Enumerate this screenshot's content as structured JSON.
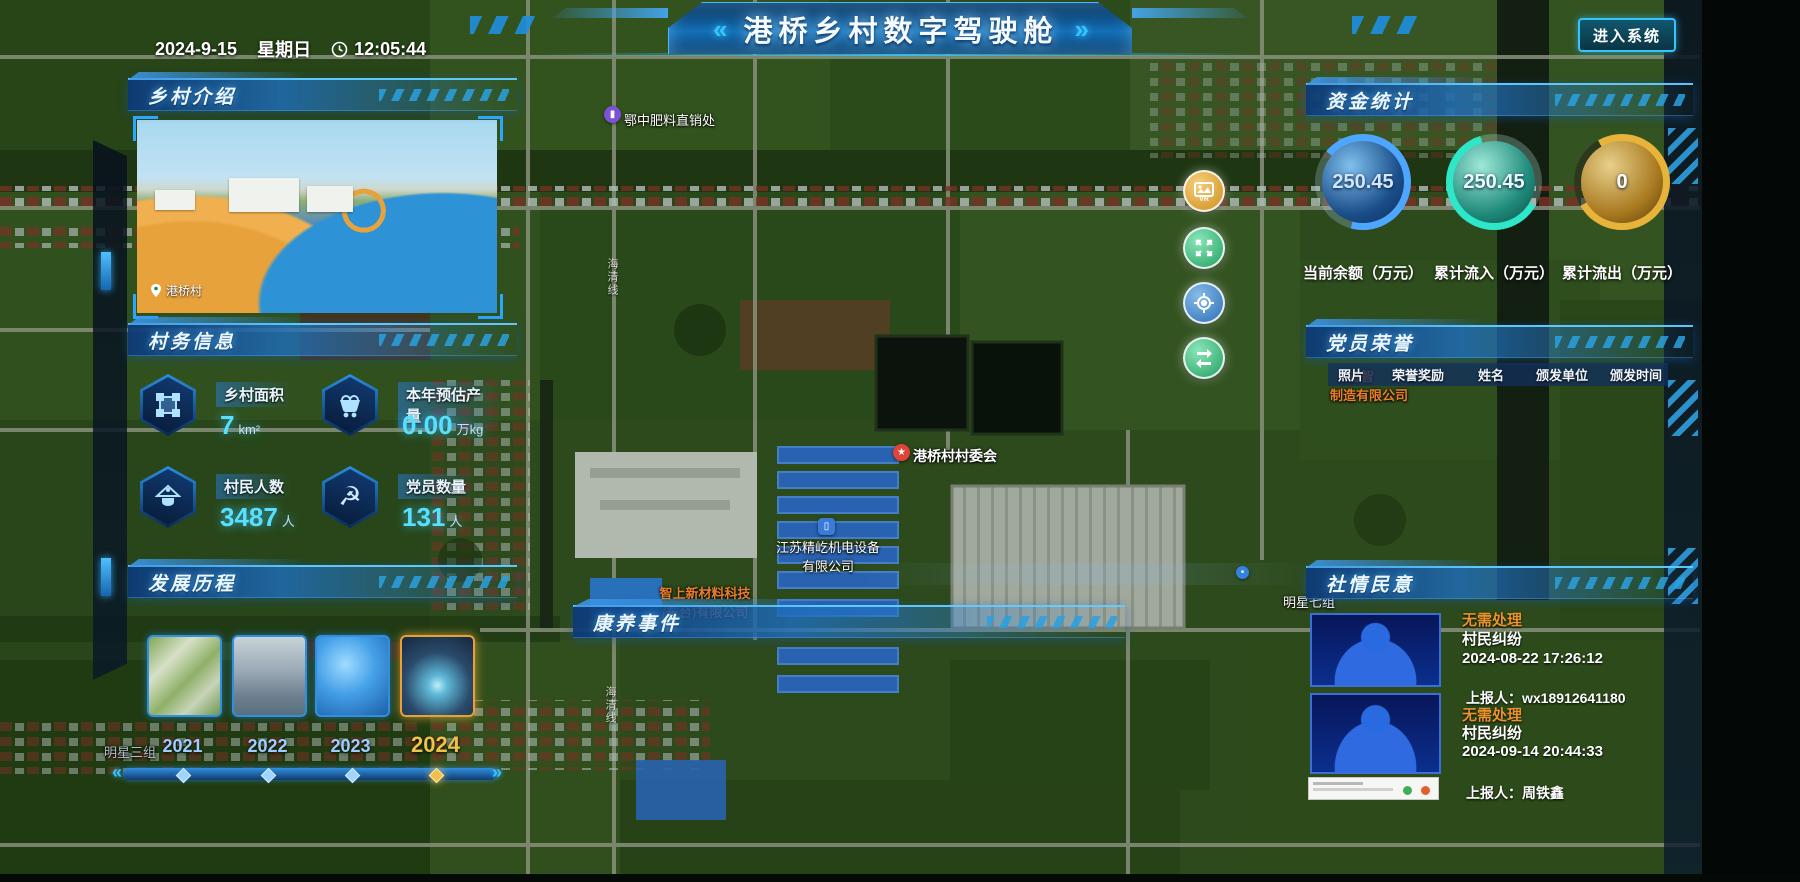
{
  "header": {
    "title": "港桥乡村数字驾驶舱",
    "chevron_left": "«",
    "chevron_right": "»",
    "date": "2024-9-15",
    "weekday": "星期日",
    "time": "12:05:44",
    "enter_button": "进入系统"
  },
  "colors": {
    "accent_cyan": "#35c4ff",
    "value_cyan": "#59e0ff",
    "status_orange": "#e8932a",
    "year_gold": "#f0c04a",
    "gauge_blue": "#4da6ff",
    "gauge_teal": "#2ee6c8",
    "gauge_gold": "#e8b33a"
  },
  "panels": {
    "intro": {
      "title": "乡村介绍",
      "photo_caption": "港桥村"
    },
    "affairs": {
      "title": "村务信息",
      "stats": [
        {
          "icon": "area-icon",
          "label": "乡村面积",
          "value": "7",
          "unit": "km²"
        },
        {
          "icon": "cart-icon",
          "label": "本年预估产量",
          "value": "0.00",
          "unit": "万kg"
        },
        {
          "icon": "villagers-icon",
          "label": "村民人数",
          "value": "3487",
          "unit": "人"
        },
        {
          "icon": "party-icon",
          "label": "党员数量",
          "value": "131",
          "unit": "人"
        }
      ]
    },
    "history": {
      "title": "发展历程",
      "years": [
        {
          "year": "2021",
          "active": false
        },
        {
          "year": "2022",
          "active": false
        },
        {
          "year": "2023",
          "active": false
        },
        {
          "year": "2024",
          "active": true
        }
      ]
    },
    "funds": {
      "title": "资金统计",
      "gauges": [
        {
          "value": "250.45",
          "label": "当前余额（万元）",
          "color": "#4da6ff"
        },
        {
          "value": "250.45",
          "label": "累计流入（万元）",
          "color": "#2ee6c8"
        },
        {
          "value": "0",
          "label": "累计流出（万元）",
          "color": "#e8b33a"
        }
      ]
    },
    "honors": {
      "title": "党员荣誉",
      "columns": [
        "照片",
        "荣誉奖励",
        "姓名",
        "颁发单位",
        "颁发时间"
      ]
    },
    "opinions": {
      "title": "社情民意",
      "items": [
        {
          "status": "无需处理",
          "type": "村民纠纷",
          "datetime": "2024-08-22 17:26:12",
          "reporter": "上报人：wx18912641180"
        },
        {
          "status": "无需处理",
          "type": "村民纠纷",
          "datetime": "2024-09-14 20:44:33",
          "reporter": "上报人：周铁鑫"
        }
      ]
    },
    "events": {
      "title": "康养事件"
    }
  },
  "map": {
    "poi": {
      "fertilizer": {
        "text": "鄂中肥料直销处",
        "pin": "purple-shop-pin"
      },
      "committee": {
        "text": "港桥村村委会",
        "pin": "red-star-pin"
      },
      "jiangsu": {
        "line1": "江苏精屹机电设备",
        "line2": "有限公司",
        "pin": "blue-building-pin"
      },
      "zhishang": {
        "line1": "智上新材料科技",
        "line2": "(东台)有限公司"
      },
      "mingxing7": {
        "text": "明星七组"
      },
      "mingxing3": {
        "text": "明星三组"
      },
      "factory": {
        "line1": "春智",
        "line2": "制造有限公司"
      },
      "road": {
        "text": "海清线"
      }
    },
    "controls": [
      {
        "name": "vr-photo",
        "glyph": "VR"
      },
      {
        "name": "expand"
      },
      {
        "name": "locate"
      },
      {
        "name": "switch",
        "glyph": "⇄"
      }
    ]
  },
  "icons": {
    "party_emblem": "☭",
    "timeline_left": "«",
    "timeline_right": "»"
  }
}
